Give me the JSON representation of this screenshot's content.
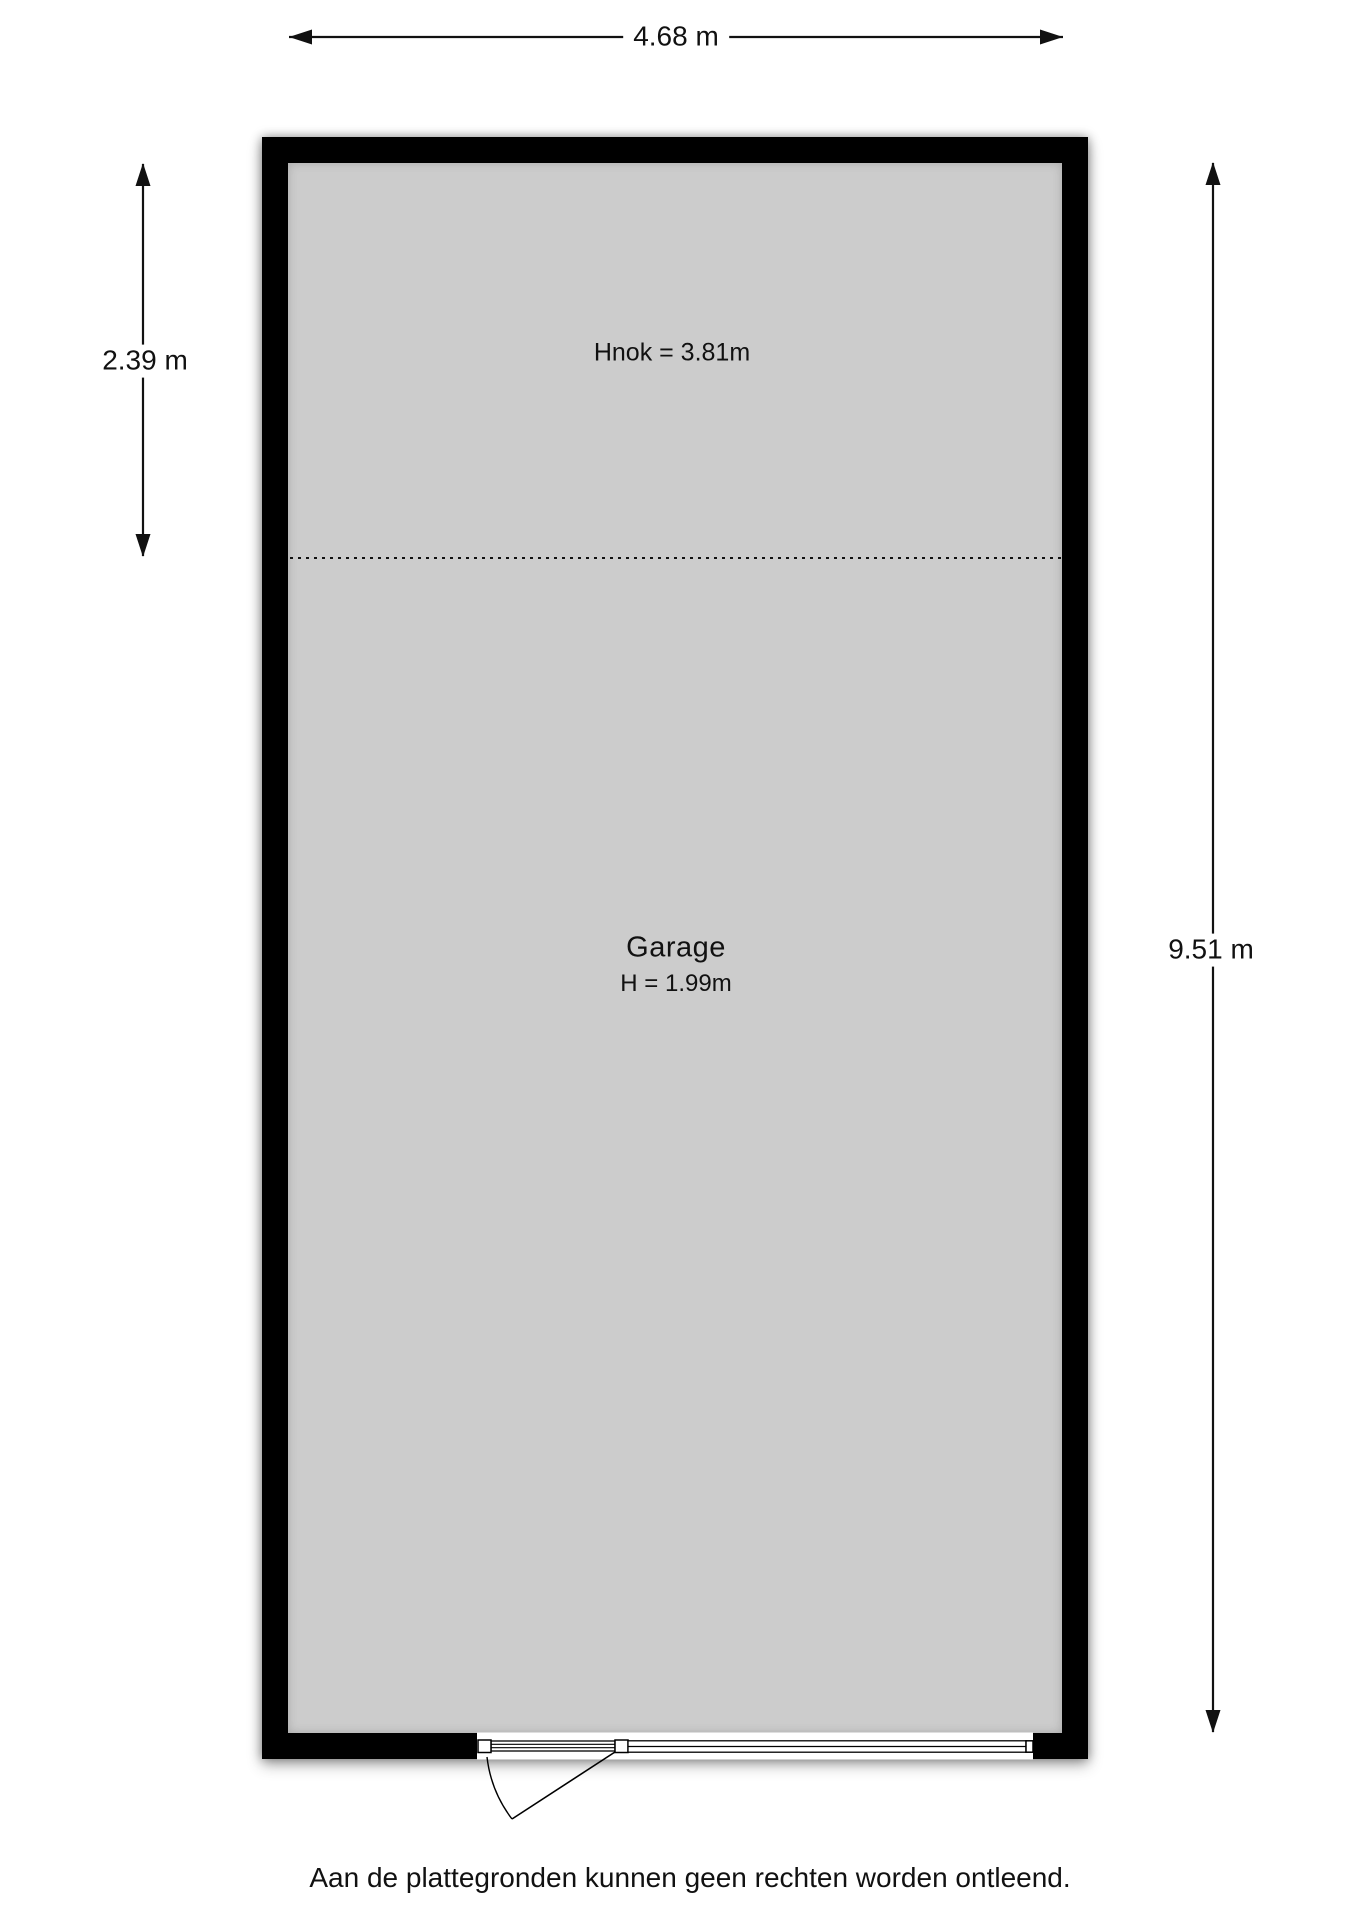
{
  "floorplan": {
    "room": {
      "name": "Garage",
      "ceiling_height": "H = 1.99m",
      "ridge_height": "Hnok = 3.81m"
    },
    "dimensions": {
      "width": "4.68 m",
      "upper_section_height": "2.39 m",
      "depth": "9.51 m"
    },
    "disclaimer": "Aan de plattegronden kunnen geen rechten worden ontleend.",
    "colors": {
      "wall": "#000000",
      "floor": "#cccccc",
      "background": "#ffffff",
      "line": "#111111"
    }
  }
}
